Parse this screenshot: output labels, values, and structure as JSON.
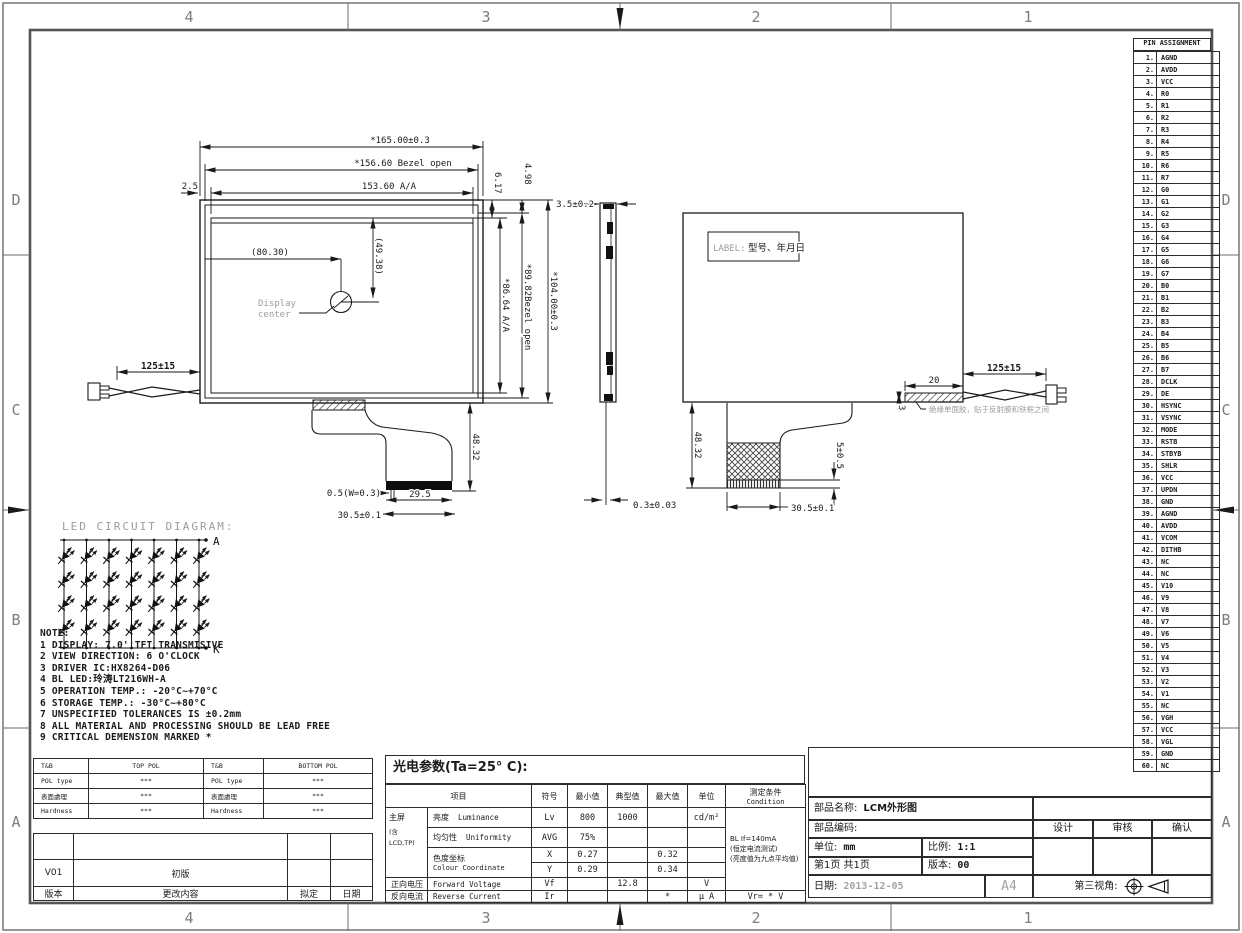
{
  "sheet": {
    "cols": [
      "4",
      "3",
      "2",
      "1"
    ],
    "rows": [
      "D",
      "C",
      "B",
      "A"
    ]
  },
  "pins": {
    "title": "PIN ASSIGNMENT",
    "items": [
      {
        "no": "1.",
        "name": "AGND"
      },
      {
        "no": "2.",
        "name": "AVDD"
      },
      {
        "no": "3.",
        "name": "VCC"
      },
      {
        "no": "4.",
        "name": "R0"
      },
      {
        "no": "5.",
        "name": "R1"
      },
      {
        "no": "6.",
        "name": "R2"
      },
      {
        "no": "7.",
        "name": "R3"
      },
      {
        "no": "8.",
        "name": "R4"
      },
      {
        "no": "9.",
        "name": "R5"
      },
      {
        "no": "10.",
        "name": "R6"
      },
      {
        "no": "11.",
        "name": "R7"
      },
      {
        "no": "12.",
        "name": "G0"
      },
      {
        "no": "13.",
        "name": "G1"
      },
      {
        "no": "14.",
        "name": "G2"
      },
      {
        "no": "15.",
        "name": "G3"
      },
      {
        "no": "16.",
        "name": "G4"
      },
      {
        "no": "17.",
        "name": "G5"
      },
      {
        "no": "18.",
        "name": "G6"
      },
      {
        "no": "19.",
        "name": "G7"
      },
      {
        "no": "20.",
        "name": "B0"
      },
      {
        "no": "21.",
        "name": "B1"
      },
      {
        "no": "22.",
        "name": "B2"
      },
      {
        "no": "23.",
        "name": "B3"
      },
      {
        "no": "24.",
        "name": "B4"
      },
      {
        "no": "25.",
        "name": "B5"
      },
      {
        "no": "26.",
        "name": "B6"
      },
      {
        "no": "27.",
        "name": "B7"
      },
      {
        "no": "28.",
        "name": "DCLK"
      },
      {
        "no": "29.",
        "name": "DE"
      },
      {
        "no": "30.",
        "name": "HSYNC"
      },
      {
        "no": "31.",
        "name": "VSYNC"
      },
      {
        "no": "32.",
        "name": "MODE"
      },
      {
        "no": "33.",
        "name": "RSTB"
      },
      {
        "no": "34.",
        "name": "STBYB"
      },
      {
        "no": "35.",
        "name": "SHLR"
      },
      {
        "no": "36.",
        "name": "VCC"
      },
      {
        "no": "37.",
        "name": "UPDN"
      },
      {
        "no": "38.",
        "name": "GND"
      },
      {
        "no": "39.",
        "name": "AGND"
      },
      {
        "no": "40.",
        "name": "AVDD"
      },
      {
        "no": "41.",
        "name": "VCOM"
      },
      {
        "no": "42.",
        "name": "DITHB"
      },
      {
        "no": "43.",
        "name": "NC"
      },
      {
        "no": "44.",
        "name": "NC"
      },
      {
        "no": "45.",
        "name": "V10"
      },
      {
        "no": "46.",
        "name": "V9"
      },
      {
        "no": "47.",
        "name": "V8"
      },
      {
        "no": "48.",
        "name": "V7"
      },
      {
        "no": "49.",
        "name": "V6"
      },
      {
        "no": "50.",
        "name": "V5"
      },
      {
        "no": "51.",
        "name": "V4"
      },
      {
        "no": "52.",
        "name": "V3"
      },
      {
        "no": "53.",
        "name": "V2"
      },
      {
        "no": "54.",
        "name": "V1"
      },
      {
        "no": "55.",
        "name": "NC"
      },
      {
        "no": "56.",
        "name": "VGH"
      },
      {
        "no": "57.",
        "name": "VCC"
      },
      {
        "no": "58.",
        "name": "VGL"
      },
      {
        "no": "59.",
        "name": "GND"
      },
      {
        "no": "60.",
        "name": "NC"
      }
    ]
  },
  "front": {
    "w_outline": "*165.00±0.3",
    "w_bezel": "*156.60 Bezel open",
    "w_aa": "153.60 A/A",
    "edge_gap": "2.5",
    "cx": "(80.30)",
    "cy": "(49.38)",
    "center_l1": "Display",
    "center_l2": "center",
    "t1": "6.17",
    "t2": "4.98",
    "h_aa": "*86.64 A/A",
    "h_bezel": "*89.82Bezel open",
    "h_outline": "*104.00±0.3",
    "wire": "125±15",
    "fpc_h": "48.32",
    "stiff": "0.5(W=0.3)",
    "fpc_w1": "29.5",
    "fpc_w2": "30.5±0.1"
  },
  "side": {
    "t": "3.5±0.2",
    "wire_d": "0.3±0.03"
  },
  "back": {
    "label1": "LABEL:",
    "label2": "型号、年月日",
    "wire": "125±15",
    "tape_w": "20",
    "tape_h": "3",
    "tape_note": "绝缘单面胶，贴于反射膜和铁框之间",
    "fpc_h": "48.32",
    "pad": "5±0.5",
    "fpc_w": "30.5±0.1"
  },
  "led": {
    "title": "LED CIRCUIT DIAGRAM:",
    "a": "A",
    "k": "K",
    "rows": 4,
    "cols": 7
  },
  "notes": {
    "title": "NOTE:",
    "items": [
      "1 DISPLAY: 7.0''TFT TRANSMISIVE",
      "2 VIEW DIRECTION: 6 O'CLOCK",
      "3 DRIVER IC:HX8264-D06",
      "4 BL LED:玲涛LT216WH-A",
      "5 OPERATION TEMP.: -20°C~+70°C",
      "6 STORAGE TEMP.: -30°C~+80°C",
      "7 UNSPECIFIED TOLERANCES IS ±0.2mm",
      "8 ALL MATERIAL AND PROCESSING SHOULD BE LEAD FREE",
      "9 CRITICAL DEMENSION MARKED *"
    ]
  },
  "pol": {
    "rows": [
      {
        "c1": "T&B",
        "c2": "TOP POL",
        "c3": "T&B",
        "c4": "BOTTOM POL"
      },
      {
        "c1": "POL type",
        "c2": "***",
        "c3": "POL type",
        "c4": "***"
      },
      {
        "c1": "表面處理",
        "c2": "***",
        "c3": "表面處理",
        "c4": "***"
      },
      {
        "c1": "Hardness",
        "c2": "***",
        "c3": "Hardness",
        "c4": "***"
      }
    ]
  },
  "revision": {
    "rows": [
      {
        "c1": "",
        "c2": "",
        "c3": "",
        "c4": ""
      },
      {
        "c1": "V01",
        "c2": "初版",
        "c3": "",
        "c4": ""
      },
      {
        "c1": "版本",
        "c2": "更改内容",
        "c3": "拟定",
        "c4": "日期"
      }
    ]
  },
  "optical": {
    "title": "光电参数(Ta=25° C):",
    "h_item": "项目",
    "h_sym": "符号",
    "h_min": "最小值",
    "h_typ": "典型值",
    "h_max": "最大值",
    "h_unit": "单位",
    "h_cond": "测定条件",
    "h_cond2": "Condition",
    "group1": "主屏",
    "group2": "(含",
    "group3": "LCD,TP)",
    "lum_cn": "亮度",
    "lum_en": "Luminance",
    "lum_sym": "Lv",
    "lum_min": "800",
    "lum_typ": "1000",
    "lum_unit": "cd/m²",
    "uni_cn": "均匀性",
    "uni_en": "Uniformity",
    "uni_sym": "AVG",
    "uni_min": "75%",
    "chroma_cn": "色度坐标",
    "chroma_en": "Colour Coordinate",
    "x_sym": "X",
    "x_min": "0.27",
    "x_max": "0.32",
    "y_sym": "Y",
    "y_min": "0.29",
    "y_max": "0.34",
    "vf_cn": "正向电压",
    "vf_en": "Forward Voltage",
    "vf_sym": "Vf",
    "vf_typ": "12.8",
    "vf_unit": "V",
    "ir_cn": "反向电流",
    "ir_en": "Reverse Current",
    "ir_sym": "Ir",
    "ir_max": "*",
    "ir_unit": "µ A",
    "ir_cond": "Vr= * V",
    "cond1": "BL If=140mA",
    "cond2": "(恒定电流测试)",
    "cond3": "(亮度值为九点平均值)"
  },
  "tb": {
    "name_label": "部品名称:",
    "name_value": "LCM外形图",
    "code_label": "部品编码:",
    "unit_label": "单位:",
    "unit_value": "mm",
    "scale_label": "比例:",
    "scale_value": "1:1",
    "page_label": "第1页 共1页",
    "ver_label": "版本:",
    "ver_value": "00",
    "date_label": "日期:",
    "date_value": "2013-12-05",
    "size": "A4",
    "proj_label": "第三视角:",
    "design": "设计",
    "audit": "审核",
    "confirm": "确认"
  }
}
